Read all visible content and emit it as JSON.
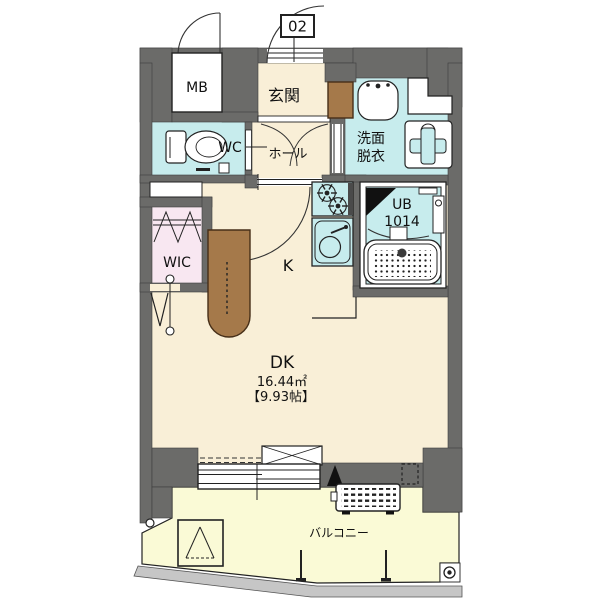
{
  "unit": {
    "number": "02"
  },
  "rooms": {
    "mb": "MB",
    "genkan": "玄関",
    "wc": "WC",
    "hall": "ホール",
    "senmen_line1": "洗面",
    "senmen_line2": "脱衣",
    "ub_line1": "UB",
    "ub_line2": "1014",
    "wic": "WIC",
    "kitchen": "K",
    "dk": "DK",
    "dk_area_m2": "16.44㎡",
    "dk_area_tatami": "【9.93帖】",
    "balcony": "バルコニー"
  },
  "colors": {
    "wall": "#6b6b69",
    "room_cream": "#f9efd7",
    "wet_blue": "#c7eced",
    "wic_pink": "#f8e7f1",
    "balcony_yellow": "#fafad6",
    "counter_brown": "#a5794a",
    "edge_gray": "#c6c6c6",
    "line": "#1a1a1a"
  }
}
